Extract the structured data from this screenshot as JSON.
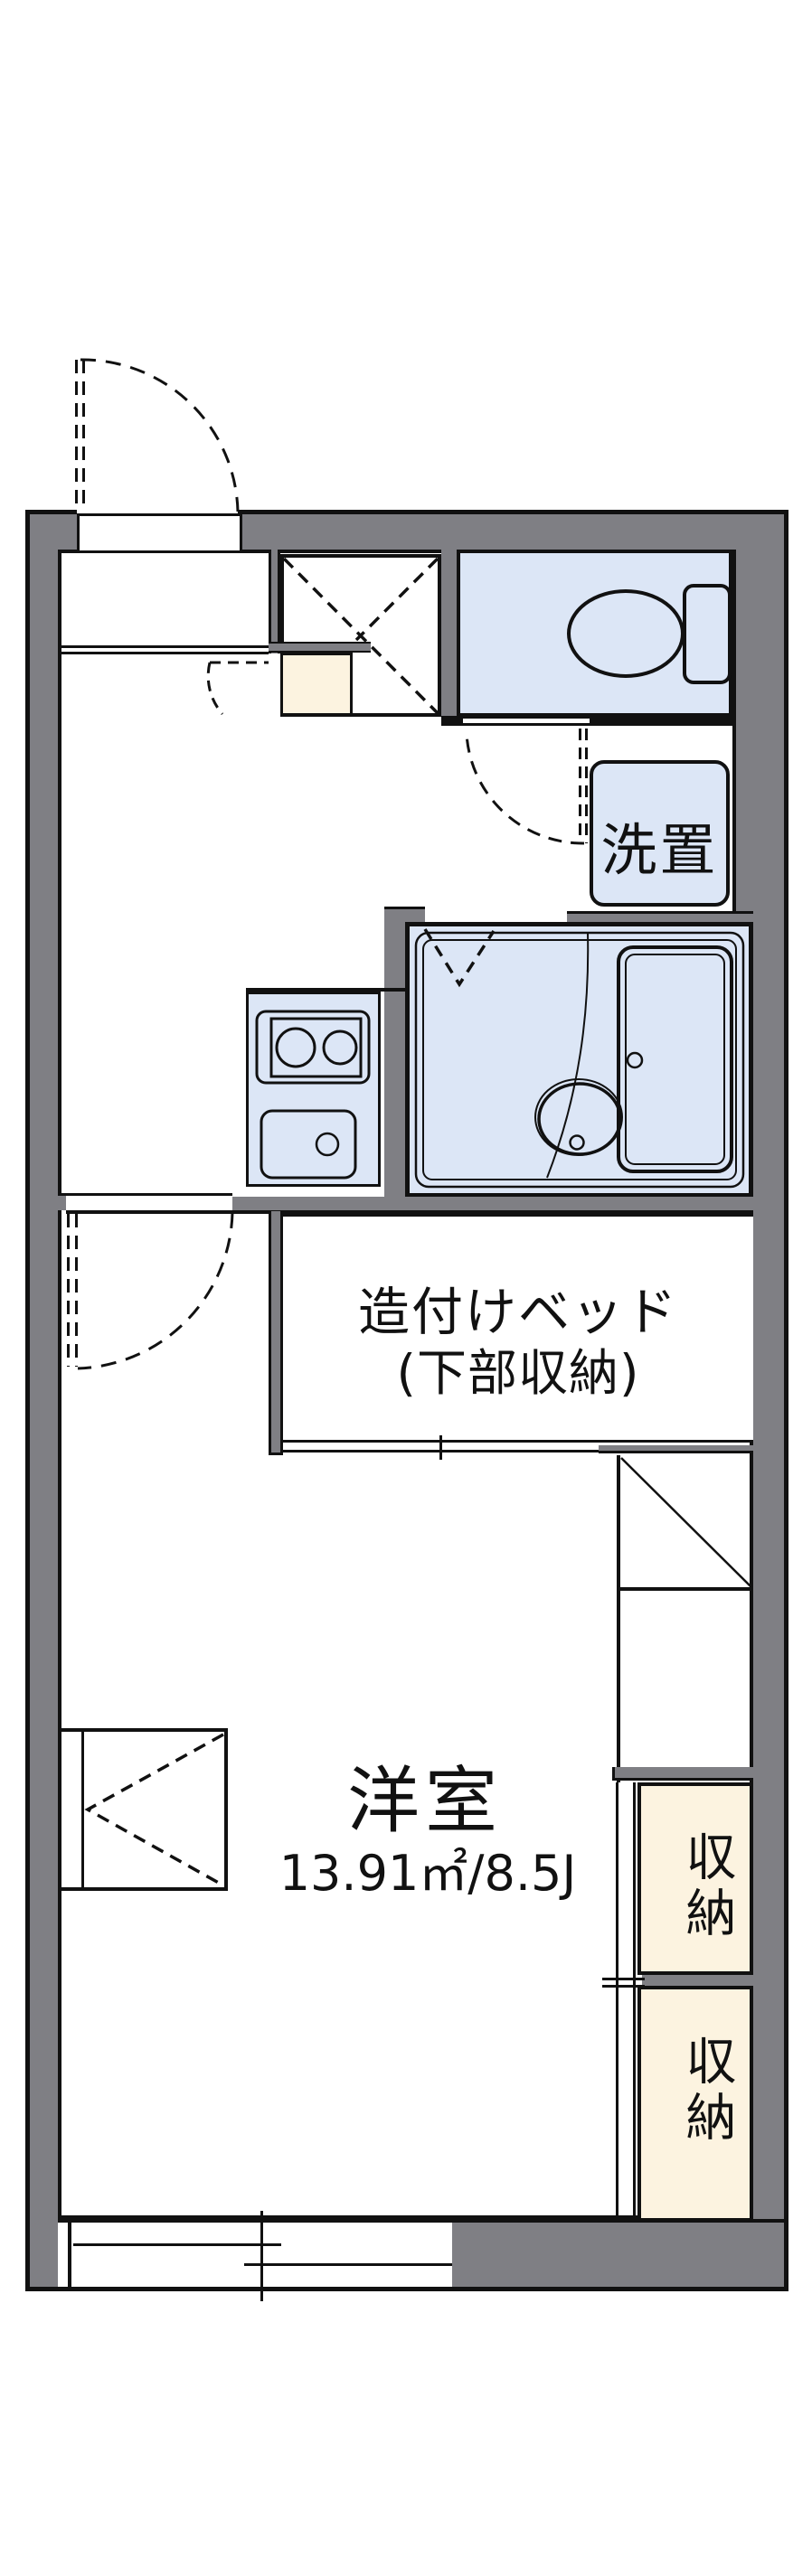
{
  "floorplan": {
    "title": "apartment-floor-plan",
    "rooms": {
      "main_room": {
        "name": "洋室",
        "area": "13.91㎡/8.5J"
      },
      "bed": {
        "label_line1": "造付けベッド",
        "label_line2": "(下部収納)"
      },
      "washer": {
        "label": "洗置"
      },
      "storage_upper": {
        "label": "収納"
      },
      "storage_lower": {
        "label": "収納"
      }
    },
    "colors": {
      "wall": "#7f7f84",
      "wet_area": "#dce6f6",
      "storage": "#fcf3e0",
      "line": "#111111",
      "background": "#ffffff"
    }
  }
}
